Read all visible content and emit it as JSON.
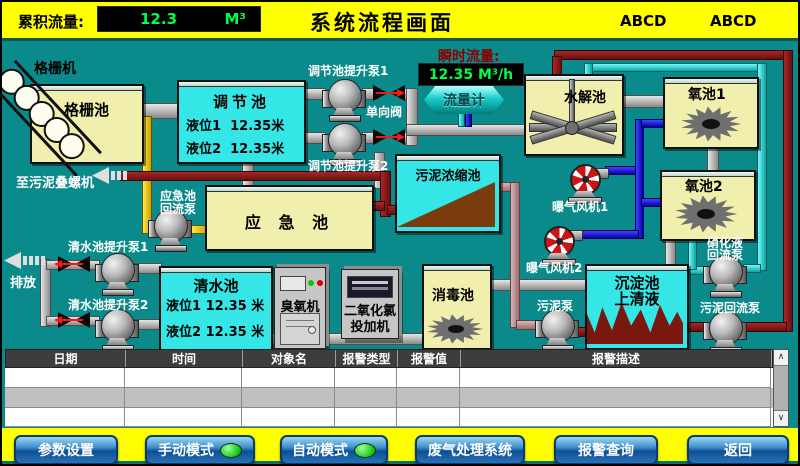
{
  "header": {
    "cumulative_label": "累积流量:",
    "cumulative_value": "12.3",
    "cumulative_unit": "M³",
    "title": "系统流程画面",
    "abcd1": "ABCD",
    "abcd2": "ABCD"
  },
  "diagram": {
    "grid_machine": "格栅机",
    "grid_pool": "格栅池",
    "to_sludge_screw": "至污泥叠螺机",
    "regulation_pool": {
      "title": "调节池",
      "level1": "液位1  12.35米",
      "level2": "液位2  12.35米"
    },
    "reg_pump1": "调节池提升泵1",
    "reg_pump2": "调节池提升泵2",
    "check_valve": "单向阀",
    "instant_flow_label": "瞬时流量:",
    "instant_flow_value": "12.35 M³/h",
    "flow_meter": "流量计",
    "hydrolysis_pool": "水解池",
    "oxygen_pool1": "氧池1",
    "oxygen_pool2": "氧池2",
    "sludge_thickener": "污泥浓缩池",
    "emergency_pool": "应 急 池",
    "emergency_pump_line1": "应急池",
    "emergency_pump_line2": "回流泵",
    "aeration_fan1": "曝气风机1",
    "aeration_fan2": "曝气风机2",
    "sediment_line1": "沉淀池",
    "sediment_line2": "上清液",
    "sludge_pump": "污泥泵",
    "nitrify_pump_line1": "硝化液",
    "nitrify_pump_line2": "回流泵",
    "sludge_return_pump": "污泥回流泵",
    "disinfection_pool": "消毒池",
    "clean_pool": {
      "title": "清水池",
      "level1": "液位1 12.35 米",
      "level2": "液位2 12.35 米"
    },
    "ozone_machine": "臭氧机",
    "cl2_doser_line1": "二氧化氯",
    "cl2_doser_line2": "投加机",
    "clean_pump1": "清水池提升泵1",
    "clean_pump2": "清水池提升泵2",
    "discharge": "排放"
  },
  "alarm_table": {
    "columns": [
      "日期",
      "时间",
      "对象名",
      "报警类型",
      "报警值",
      "报警描述"
    ],
    "visible_empty_rows": 3
  },
  "footer": {
    "buttons": [
      {
        "label": "参数设置",
        "led": false
      },
      {
        "label": "手动模式",
        "led": true
      },
      {
        "label": "自动模式",
        "led": true
      },
      {
        "label": "废气处理系统",
        "led": false
      },
      {
        "label": "报警查询",
        "led": false
      },
      {
        "label": "返回",
        "led": false
      }
    ]
  },
  "colors": {
    "background": "#0a8a8a",
    "panel_yellow": "#ffff00",
    "tank_yellow": "#f0efad",
    "tank_cyan": "#35e6e6",
    "display_green": "#00ff44",
    "instant_label_red": "#8b0000",
    "pipe_gray": "#b8b8b8",
    "pipe_yellow": "#ffd900",
    "pipe_dark_red": "#8b1c1c",
    "pipe_cyan": "#22dede",
    "pipe_blue": "#1414d8",
    "sludge_brown": "#7a3c0c",
    "alarm_header_bg": "#3d3d3d",
    "button_blue": "#1565ab",
    "led_green": "#22dd22"
  }
}
